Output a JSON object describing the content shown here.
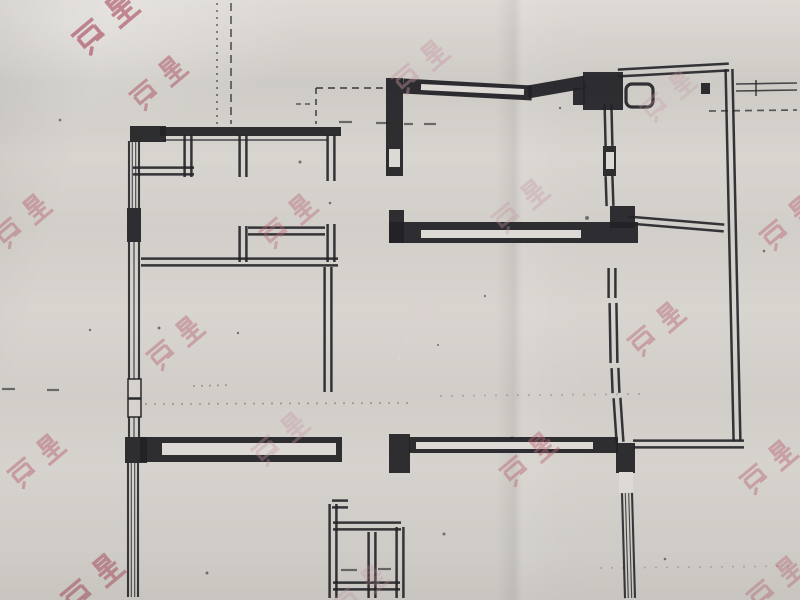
{
  "meta": {
    "description": "Photograph of a black-and-white apartment floor-plan drawing on creased paper with repeated pink real-estate watermarks"
  },
  "palette": {
    "paper": "#d7d3ce",
    "paper_light": "#ddd9d4",
    "ink": "#232327",
    "wm_strong": "#a84a5e",
    "wm_mid": "#b86677",
    "wm_soft": "#c697a0",
    "wm_light": "#ddd2d0"
  },
  "watermark": {
    "text": "房星",
    "rotation_deg": -40,
    "instances": [
      {
        "x": 105,
        "y": 22,
        "c": "wm_strong",
        "o": 0.62,
        "s": 1.15
      },
      {
        "x": 158,
        "y": 82,
        "c": "wm_strong",
        "o": 0.48,
        "s": 1.0
      },
      {
        "x": 420,
        "y": 66,
        "c": "wm_soft",
        "o": 0.42,
        "s": 1.0
      },
      {
        "x": 668,
        "y": 95,
        "c": "wm_soft",
        "o": 0.3,
        "s": 0.95
      },
      {
        "x": 22,
        "y": 220,
        "c": "wm_mid",
        "o": 0.45,
        "s": 1.0
      },
      {
        "x": 288,
        "y": 220,
        "c": "wm_mid",
        "o": 0.4,
        "s": 1.0
      },
      {
        "x": 520,
        "y": 205,
        "c": "wm_soft",
        "o": 0.35,
        "s": 1.0
      },
      {
        "x": 788,
        "y": 222,
        "c": "wm_mid",
        "o": 0.45,
        "s": 1.0
      },
      {
        "x": 175,
        "y": 342,
        "c": "wm_mid",
        "o": 0.45,
        "s": 1.0
      },
      {
        "x": 412,
        "y": 330,
        "c": "wm_light",
        "o": 0.6,
        "s": 1.05
      },
      {
        "x": 656,
        "y": 328,
        "c": "wm_mid",
        "o": 0.45,
        "s": 1.0
      },
      {
        "x": 36,
        "y": 460,
        "c": "wm_mid",
        "o": 0.5,
        "s": 1.0
      },
      {
        "x": 280,
        "y": 438,
        "c": "wm_soft",
        "o": 0.35,
        "s": 1.0
      },
      {
        "x": 528,
        "y": 458,
        "c": "wm_mid",
        "o": 0.45,
        "s": 1.0
      },
      {
        "x": 768,
        "y": 466,
        "c": "wm_mid",
        "o": 0.45,
        "s": 1.0
      },
      {
        "x": 92,
        "y": 582,
        "c": "wm_strong",
        "o": 0.52,
        "s": 1.1
      },
      {
        "x": 360,
        "y": 590,
        "c": "wm_soft",
        "o": 0.28,
        "s": 0.95
      },
      {
        "x": 775,
        "y": 582,
        "c": "wm_mid",
        "o": 0.4,
        "s": 1.0
      }
    ]
  },
  "floorplan": {
    "solids": [
      [
        130,
        126,
        36,
        16
      ],
      [
        160,
        127,
        181,
        9
      ],
      [
        127,
        208,
        14,
        34
      ],
      [
        125,
        437,
        22,
        26
      ],
      [
        140,
        437,
        202,
        25
      ],
      [
        386,
        78,
        17,
        98
      ],
      [
        389,
        210,
        15,
        33
      ],
      [
        389,
        222,
        249,
        21
      ],
      [
        610,
        206,
        25,
        22
      ],
      [
        583,
        72,
        40,
        38
      ],
      [
        573,
        88,
        12,
        17
      ],
      [
        701,
        83,
        9,
        11
      ],
      [
        603,
        146,
        13,
        30
      ],
      [
        389,
        434,
        21,
        39
      ],
      [
        409,
        437,
        209,
        16
      ],
      [
        616,
        443,
        19,
        30
      ]
    ],
    "white_boxes": [
      [
        162,
        443,
        174,
        12
      ],
      [
        421,
        230,
        160,
        8
      ],
      [
        389,
        149,
        11,
        18
      ],
      [
        416,
        442,
        177,
        7
      ],
      [
        619,
        472,
        14,
        21
      ],
      [
        606,
        152,
        8,
        17
      ]
    ],
    "pane_boxes": [
      [
        128,
        379,
        13,
        19
      ],
      [
        128,
        399,
        13,
        18
      ]
    ],
    "double_walls": [
      [
        331,
        135,
        331,
        181
      ],
      [
        188,
        135,
        188,
        177
      ],
      [
        133,
        171,
        194,
        171
      ],
      [
        243,
        135,
        243,
        177
      ],
      [
        243,
        226,
        243,
        262
      ],
      [
        331,
        224,
        331,
        262
      ],
      [
        248,
        231,
        325,
        231
      ],
      [
        141,
        262,
        338,
        262
      ],
      [
        328,
        267,
        328,
        392
      ],
      [
        618,
        73,
        729,
        67
      ],
      [
        729,
        69,
        737,
        441
      ],
      [
        608,
        104,
        609,
        146
      ],
      [
        609,
        176,
        610,
        206
      ],
      [
        612,
        268,
        612,
        298
      ],
      [
        613,
        303,
        614,
        363
      ],
      [
        615,
        368,
        616,
        393
      ],
      [
        617,
        398,
        620,
        442
      ],
      [
        628,
        220,
        724,
        228
      ],
      [
        633,
        444,
        744,
        444
      ],
      [
        333,
        504,
        333,
        598
      ],
      [
        332,
        504,
        348,
        504
      ],
      [
        333,
        526,
        401,
        526
      ],
      [
        372,
        532,
        372,
        598
      ],
      [
        400,
        527,
        400,
        598
      ],
      [
        333,
        586,
        400,
        586
      ]
    ],
    "thick_lines": [
      [
        403,
        86,
        532,
        93,
        15
      ],
      [
        528,
        92,
        585,
        82,
        13
      ]
    ],
    "white_lines": [
      [
        421,
        87,
        524,
        92,
        6
      ]
    ],
    "windows": [
      [
        134,
        141,
        134,
        208,
        "dense"
      ],
      [
        134,
        242,
        134,
        379,
        "plain"
      ],
      [
        134,
        417,
        134,
        437,
        "plain"
      ],
      [
        133,
        463,
        133,
        597,
        "dense"
      ],
      [
        627,
        493,
        630,
        598,
        "dense"
      ]
    ],
    "thin_lines": [
      [
        163,
        140,
        327,
        140
      ],
      [
        736,
        84,
        797,
        83
      ],
      [
        736,
        91,
        797,
        90
      ],
      [
        756,
        80,
        756,
        96
      ]
    ],
    "dashed_lines": [
      [
        217,
        3,
        217,
        124,
        "2 5",
        0.6
      ],
      [
        231,
        3,
        231,
        124,
        "8 5",
        0.7
      ],
      [
        316,
        88,
        389,
        88,
        "7 5",
        0.75
      ],
      [
        316,
        88,
        316,
        124,
        "6 5",
        0.75
      ],
      [
        296,
        104,
        314,
        104,
        "5 4",
        0.6
      ],
      [
        709,
        111,
        797,
        110,
        "7 5",
        0.7
      ],
      [
        145,
        404,
        410,
        403,
        "2 7",
        0.3
      ],
      [
        440,
        396,
        640,
        394,
        "2 9",
        0.22
      ],
      [
        600,
        568,
        797,
        566,
        "2 9",
        0.2
      ],
      [
        193,
        386,
        233,
        385,
        "2 6",
        0.3
      ]
    ],
    "small_dashes": [
      [
        339,
        122,
        352,
        122
      ],
      [
        376,
        123,
        389,
        123
      ],
      [
        404,
        124,
        413,
        124
      ],
      [
        424,
        124,
        436,
        124
      ],
      [
        341,
        570,
        357,
        570
      ],
      [
        378,
        569,
        391,
        569
      ],
      [
        2,
        389,
        15,
        389
      ],
      [
        47,
        390,
        59,
        390
      ]
    ],
    "specks": [
      [
        300,
        162,
        1.5
      ],
      [
        330,
        203,
        1.3
      ],
      [
        159,
        328,
        1.5
      ],
      [
        238,
        333,
        1.2
      ],
      [
        560,
        108,
        1.2
      ],
      [
        587,
        218,
        2.0
      ],
      [
        512,
        438,
        1.5
      ],
      [
        444,
        534,
        1.5
      ],
      [
        207,
        573,
        1.5
      ],
      [
        665,
        559,
        1.3
      ],
      [
        764,
        251,
        1.3
      ],
      [
        485,
        296,
        1.1
      ],
      [
        438,
        345,
        1.0
      ],
      [
        90,
        330,
        1.2
      ],
      [
        60,
        120,
        1.3
      ]
    ],
    "rounded_rect": {
      "x": 626,
      "y": 84,
      "w": 27,
      "h": 23,
      "r": 6
    }
  }
}
